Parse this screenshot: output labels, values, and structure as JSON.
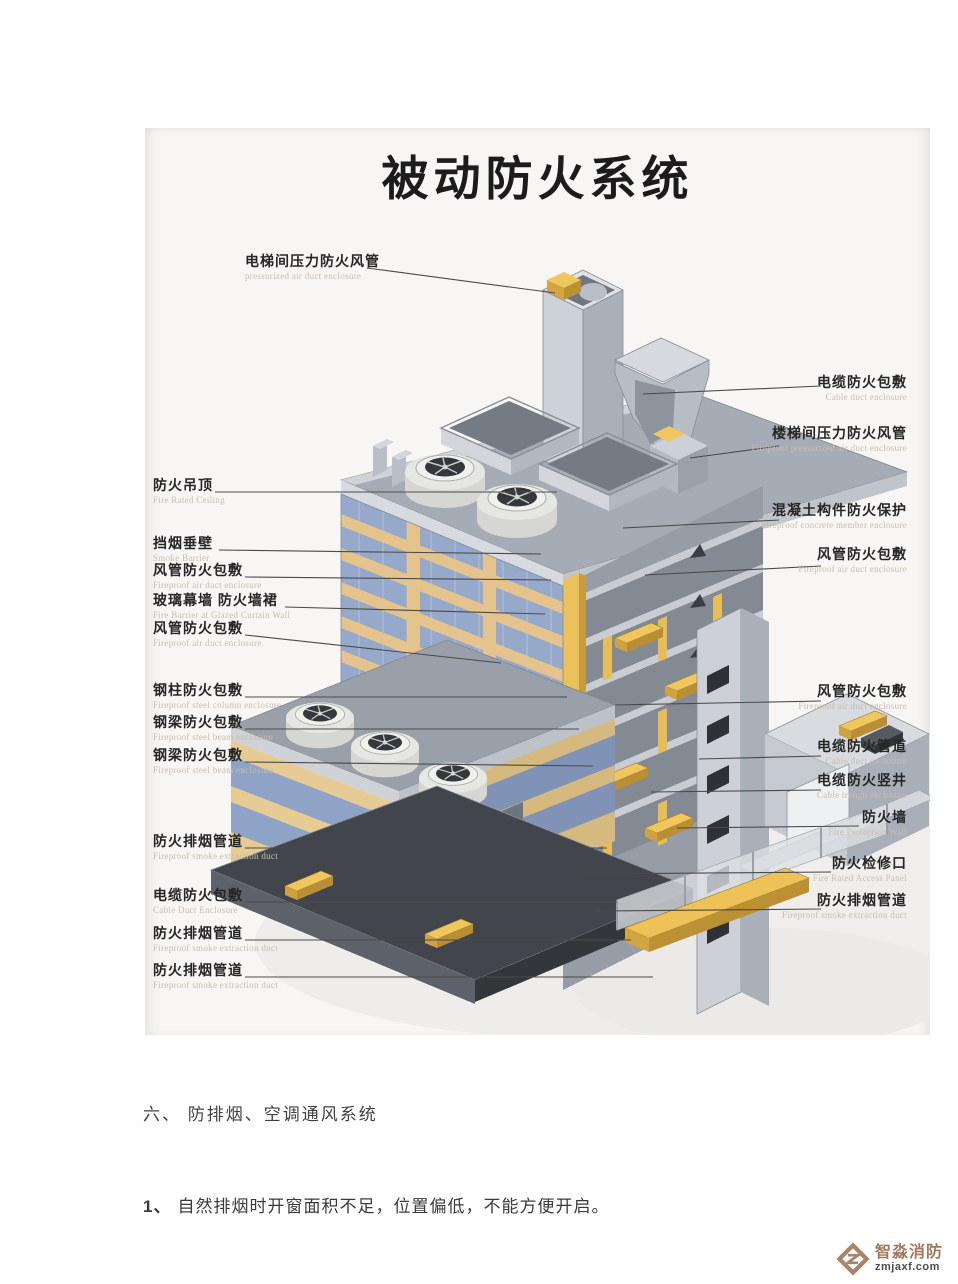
{
  "diagram": {
    "title": "被动防火系统",
    "labels_left": [
      {
        "zh": "电梯间压力防火风管",
        "en": "pressurized air duct enclosure"
      },
      {
        "zh": "防火吊顶",
        "en": "Fire Rated Ceiling"
      },
      {
        "zh": "挡烟垂壁",
        "en": "Smoke Barrier"
      },
      {
        "zh": "风管防火包敷",
        "en": "Fireproof air duct enclosure"
      },
      {
        "zh": "玻璃幕墙 防火墙裙",
        "en": "Fire Barrier at Glazed Curtain Wall"
      },
      {
        "zh": "风管防火包敷",
        "en": "Fireproof air duct enclosure"
      },
      {
        "zh": "钢柱防火包敷",
        "en": "Fireproof steel column enclosure"
      },
      {
        "zh": "钢梁防火包敷",
        "en": "Fireproof steel beam enclosure"
      },
      {
        "zh": "钢梁防火包敷",
        "en": "Fireproof steel beam enclosure"
      },
      {
        "zh": "防火排烟管道",
        "en": "Fireproof smoke extraction duct"
      },
      {
        "zh": "电缆防火包敷",
        "en": "Cable Duct Enclosure"
      },
      {
        "zh": "防火排烟管道",
        "en": "Fireproof smoke extraction duct"
      },
      {
        "zh": "防火排烟管道",
        "en": "Fireproof smoke extraction duct"
      }
    ],
    "labels_right": [
      {
        "zh": "电缆防火包敷",
        "en": "Cable duct enclosure"
      },
      {
        "zh": "楼梯间压力防火风管",
        "en": "Fireproof pressurized air duct enclosure"
      },
      {
        "zh": "混凝土构件防火保护",
        "en": "Fireproof concrete member enclosure"
      },
      {
        "zh": "风管防火包敷",
        "en": "Fireproof air duct enclosure"
      },
      {
        "zh": "风管防火包敷",
        "en": "Fireproof air duct enclosure"
      },
      {
        "zh": "电缆防火管道",
        "en": "Cable duct enclosure"
      },
      {
        "zh": "电缆防火竖井",
        "en": "Cable trough enclosure"
      },
      {
        "zh": "防火墙",
        "en": "Fire Protection Wall"
      },
      {
        "zh": "防火检修口",
        "en": "Fire Rated Access Panel"
      },
      {
        "zh": "防火排烟管道",
        "en": "Fireproof smoke extraction duct"
      }
    ],
    "colors": {
      "duct_yellow": "#f0c75e",
      "glass_blue": "#96a9ca",
      "band_tan": "#e4c48c",
      "concrete_gray": "#a6acb5",
      "ground_dark": "#42464c"
    }
  },
  "body_text": {
    "section_heading": "六、 防排烟、空调通风系统",
    "item_number": "1、",
    "item_text": "自然排烟时开窗面积不足，位置偏低，不能方便开启。"
  },
  "footer_logo": {
    "name": "智淼消防",
    "domain": "zmjaxf.com"
  }
}
